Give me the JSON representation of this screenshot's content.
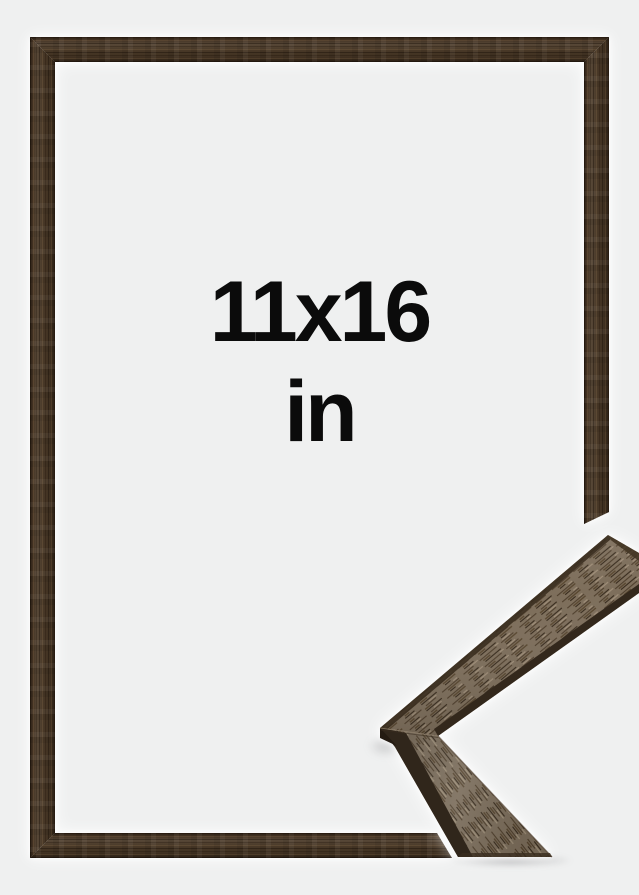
{
  "image_meta": {
    "kind": "product-photo",
    "subject": "wooden picture frame with corner profile detail",
    "background_color": "#eff0f0"
  },
  "size_label": {
    "dimensions": "11x16",
    "unit": "in",
    "text_color": "#0b0b0b"
  },
  "frame": {
    "front_view": "full frame, dark walnut brown wood, thin flat profile",
    "corner_detail_view": "angled close-up of mitered corner profile",
    "colors": {
      "wood_dark": "#4b3a28",
      "wood_grain_light": "#967652",
      "sample_face_mid": "#7d6e5b",
      "sample_edge_dark": "#30261b",
      "halo": "#ffffff",
      "shadow": "#5a5a5f"
    }
  }
}
